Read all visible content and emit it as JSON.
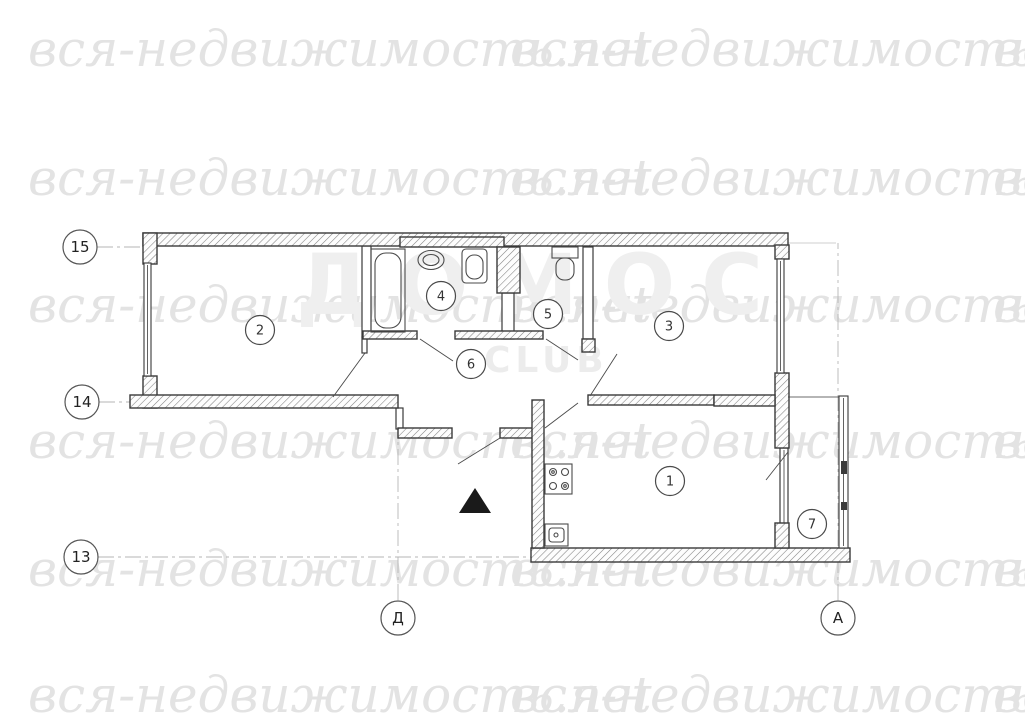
{
  "watermark": {
    "text": "вся-недвижимость.net",
    "color": "#e3e3e3",
    "rows_y": [
      20,
      149,
      276,
      412,
      540,
      666
    ],
    "cols_x": [
      28,
      510,
      993
    ]
  },
  "background_logo": {
    "line1": "ДОМОС",
    "line2": "CLUB",
    "color": "#efefef"
  },
  "plan": {
    "line_color": "#3a3a3a",
    "axis_line_color": "#b5b5b5",
    "entrance_marker_color": "#1a1a1a",
    "room_labels": [
      {
        "id": "1",
        "x": 670,
        "y": 481
      },
      {
        "id": "2",
        "x": 260,
        "y": 330
      },
      {
        "id": "3",
        "x": 669,
        "y": 326
      },
      {
        "id": "4",
        "x": 441,
        "y": 296
      },
      {
        "id": "5",
        "x": 548,
        "y": 314
      },
      {
        "id": "6",
        "x": 471,
        "y": 364
      },
      {
        "id": "7",
        "x": 812,
        "y": 524
      }
    ],
    "axis_labels": [
      {
        "id": "15",
        "x": 80,
        "y": 247
      },
      {
        "id": "14",
        "x": 82,
        "y": 402
      },
      {
        "id": "13",
        "x": 81,
        "y": 557
      },
      {
        "id": "Д",
        "x": 398,
        "y": 618
      },
      {
        "id": "А",
        "x": 838,
        "y": 618
      }
    ]
  }
}
